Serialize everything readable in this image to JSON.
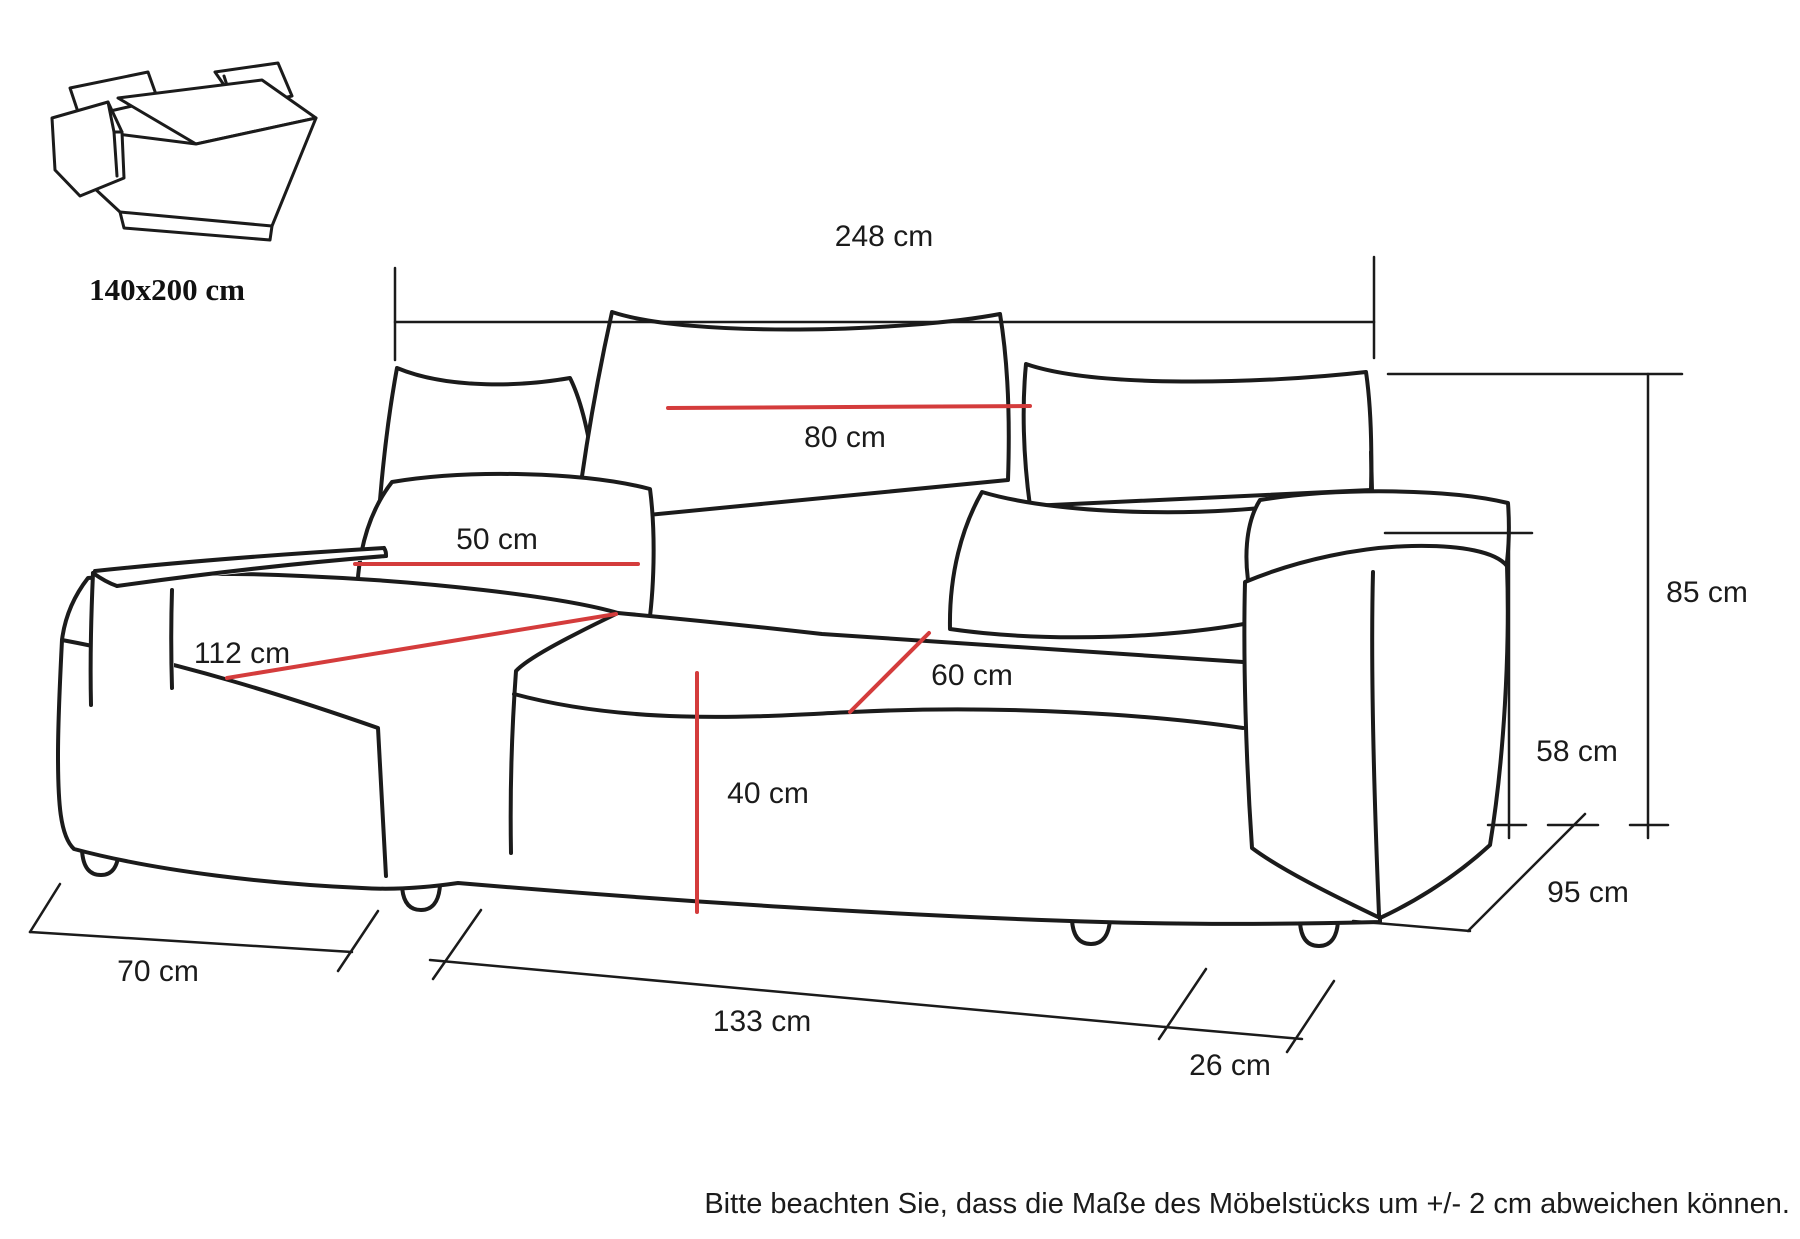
{
  "inset": {
    "bed_size_label": "140x200 cm"
  },
  "dimensions": {
    "total_width": {
      "value": "248 cm"
    },
    "back_cushion_width": {
      "value": "80 cm"
    },
    "small_cushion_width": {
      "value": "50 cm"
    },
    "chaise_depth": {
      "value": "112 cm"
    },
    "seat_cushion_width": {
      "value": "60 cm"
    },
    "seat_height": {
      "value": "40 cm"
    },
    "total_height": {
      "value": "85 cm"
    },
    "armrest_height": {
      "value": "58 cm"
    },
    "depth": {
      "value": "95 cm"
    },
    "chaise_width": {
      "value": "70 cm"
    },
    "front_width": {
      "value": "133 cm"
    },
    "armrest_width": {
      "value": "26 cm"
    }
  },
  "note_text": "Bitte beachten Sie, dass die Maße des Möbelstücks um +/- 2 cm abweichen können.",
  "colors": {
    "line": "#1b1b1b",
    "dimension_red": "#d43c3c"
  }
}
